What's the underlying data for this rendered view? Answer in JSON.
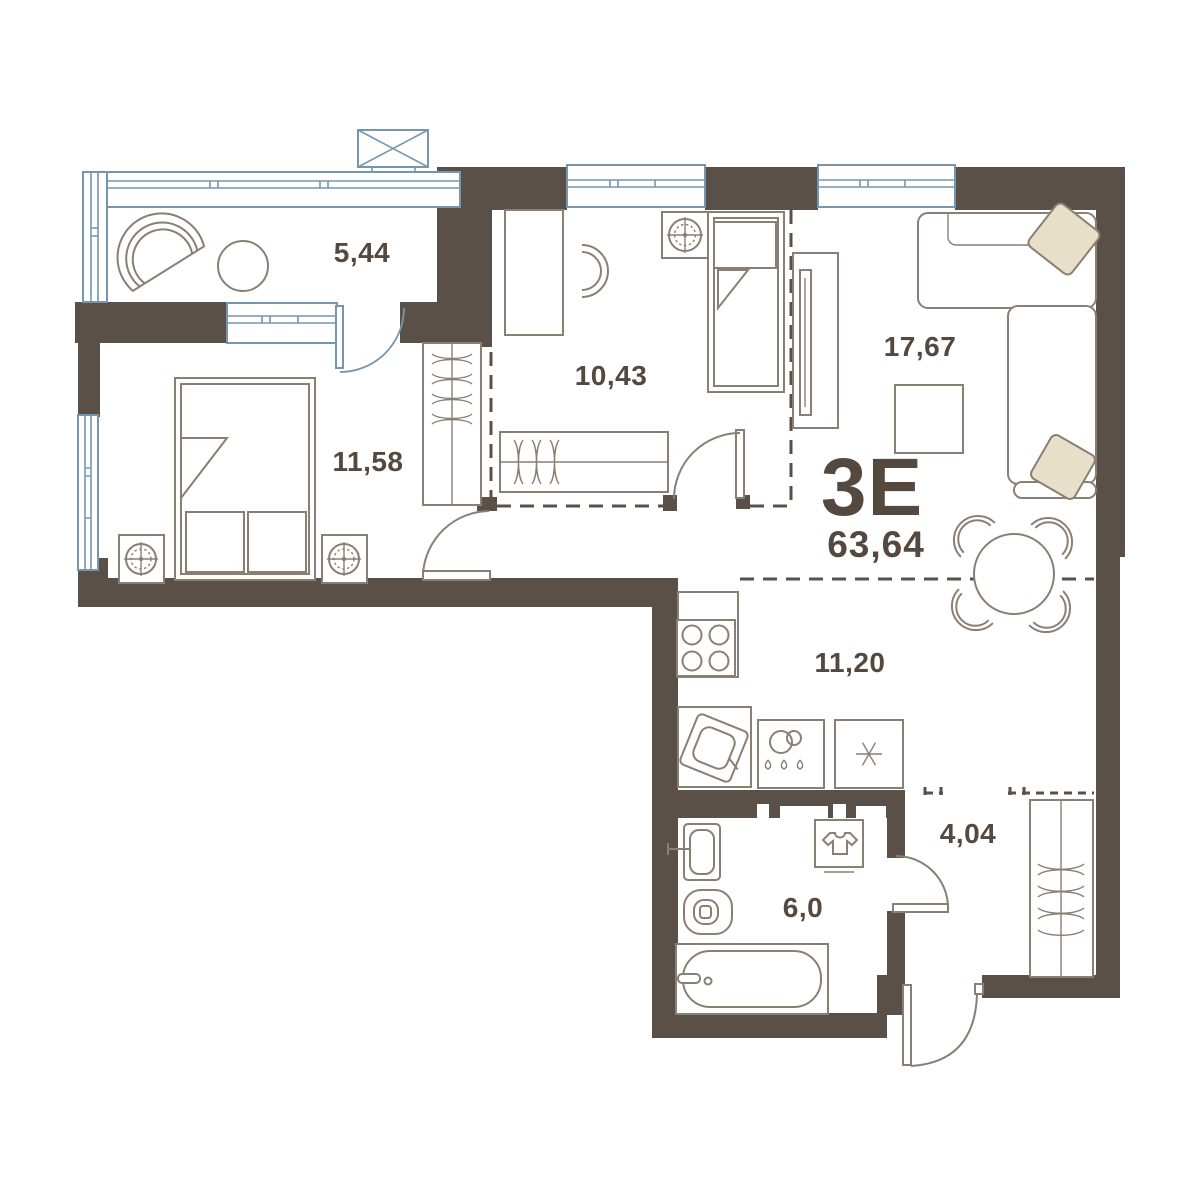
{
  "plan": {
    "type_label": "3Е",
    "total_area": "63,64",
    "rooms": [
      {
        "name": "loggia",
        "area": "5,44"
      },
      {
        "name": "bedroom",
        "area": "11,58"
      },
      {
        "name": "children-room",
        "area": "10,43"
      },
      {
        "name": "living-room",
        "area": "17,67"
      },
      {
        "name": "kitchen-dining",
        "area": "11,20"
      },
      {
        "name": "bathroom",
        "area": "6,0"
      },
      {
        "name": "hallway",
        "area": "4,04"
      }
    ],
    "colors": {
      "wall": "#5b5047",
      "window": "#7596ae",
      "furniture": "#8b7f73",
      "accent": "#e8dfc9",
      "label": "#55493f",
      "bg": "#ffffff"
    }
  }
}
